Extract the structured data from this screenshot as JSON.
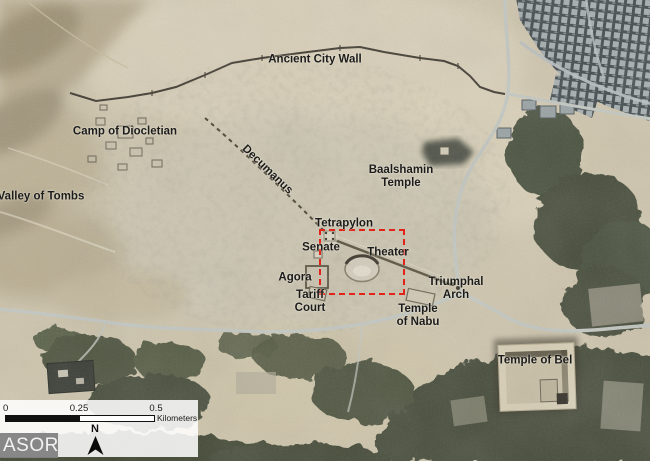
{
  "map": {
    "description": "satellite-map",
    "label_color": "#1b1b1b",
    "labels": [
      {
        "id": "ancient-city-wall",
        "text": "Ancient City Wall",
        "x": 315,
        "y": 60
      },
      {
        "id": "camp-of-diocletian",
        "text": "Camp of Diocletian",
        "x": 125,
        "y": 132
      },
      {
        "id": "valley-of-tombs",
        "text": "Valley of Tombs",
        "x": 41,
        "y": 197
      },
      {
        "id": "decumanus",
        "text": "Decumanus",
        "x": 267,
        "y": 170,
        "rotate": 44
      },
      {
        "id": "baalshamin-temple",
        "lines": [
          "Baalshamin",
          "Temple"
        ],
        "x": 401,
        "y": 177
      },
      {
        "id": "tetrapylon",
        "text": "Tetrapylon",
        "x": 344,
        "y": 224
      },
      {
        "id": "senate",
        "text": "Senate",
        "x": 321,
        "y": 248
      },
      {
        "id": "theater",
        "text": "Theater",
        "x": 388,
        "y": 253
      },
      {
        "id": "agora",
        "text": "Agora",
        "x": 295,
        "y": 278
      },
      {
        "id": "tariff-court",
        "lines": [
          "Tariff",
          "Court"
        ],
        "x": 310,
        "y": 302
      },
      {
        "id": "triumphal-arch",
        "lines": [
          "Triumphal",
          "Arch"
        ],
        "x": 456,
        "y": 289
      },
      {
        "id": "temple-of-nabu",
        "lines": [
          "Temple",
          "of Nabu"
        ],
        "x": 418,
        "y": 316
      },
      {
        "id": "temple-of-bel",
        "text": "Temple of Bel",
        "x": 535,
        "y": 361
      }
    ],
    "highlight_box": {
      "x": 319,
      "y": 229,
      "width": 82,
      "height": 62,
      "color": "#e2231a"
    }
  },
  "scalebar": {
    "ticks": [
      "0",
      "0.25",
      "0.5"
    ],
    "unit": "Kilometers"
  },
  "north_arrow": {
    "label": "N"
  },
  "logo": {
    "text": "ASOR"
  },
  "colors": {
    "desert_base": "#cec5ad",
    "desert_light": "#d9d0b9",
    "hills": "#b3a88c",
    "vegetation": "#4c5340",
    "city_block": "#a6aeb0",
    "city_shadow": "#434c4f",
    "road": "#c3c7c1",
    "wall": "#3f3a30",
    "highlight": "#e2231a",
    "panel": "#ffffff",
    "logo_bg": "#828282",
    "logo_text": "#f2f2f2"
  }
}
